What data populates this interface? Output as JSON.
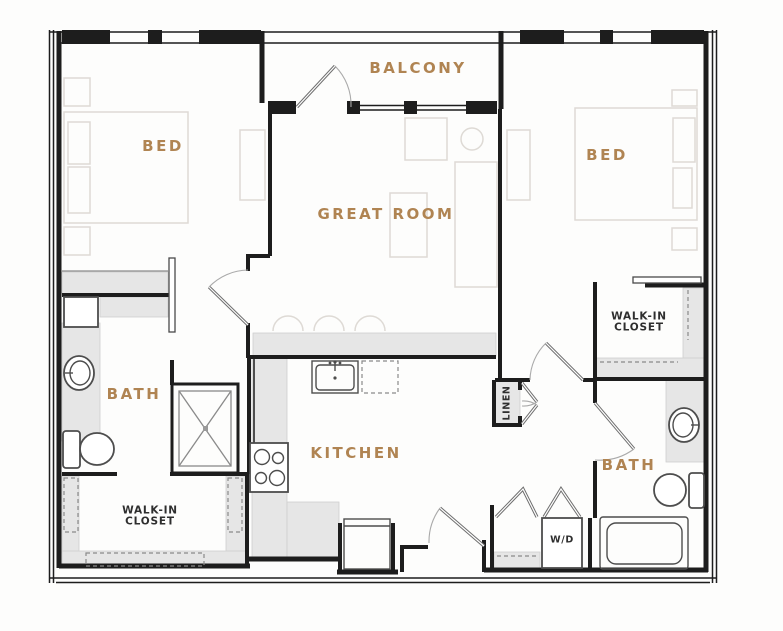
{
  "plan": {
    "type": "apartment-floor-plan",
    "labels": {
      "balcony": "BALCONY",
      "bed_left": "BED",
      "bed_right": "BED",
      "great_room": "GREAT ROOM",
      "kitchen": "KITCHEN",
      "bath_left": "BATH",
      "bath_right": "BATH",
      "walkin_left": {
        "line1": "WALK-IN",
        "line2": "CLOSET"
      },
      "walkin_right": {
        "line1": "WALK-IN",
        "line2": "CLOSET"
      },
      "linen": "LINEN",
      "washer_dryer": "W/D"
    },
    "colors": {
      "room_label": "#b08452",
      "utility_label": "#2e2e2e",
      "wall": "#1d1d1d",
      "counter_fill": "#e6e6e6",
      "furniture_line": "#dedad5",
      "fixture_line": "#4d4d4d",
      "background": "#fdfdfc"
    }
  }
}
